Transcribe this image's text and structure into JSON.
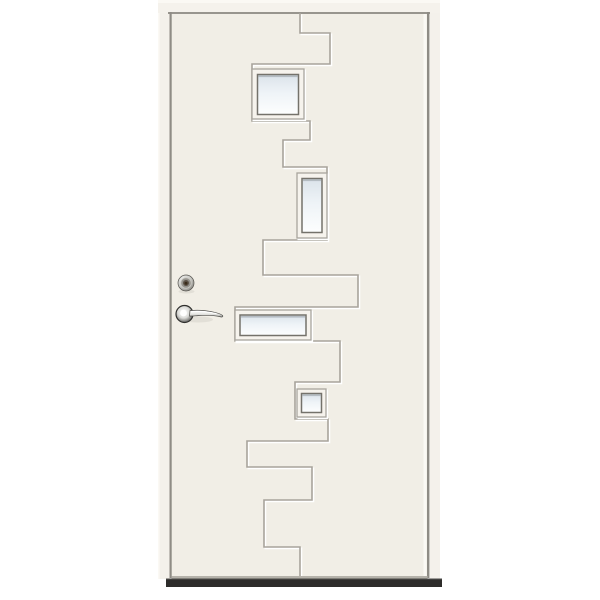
{
  "meta": {
    "domain": "natural-image",
    "subject": "white-front-door-with-zigzag-glazing",
    "canvas": [
      600,
      600
    ],
    "background": "#ffffff"
  },
  "palette": {
    "door_face": "#f1eee6",
    "frame_strip": "#f4f1eb",
    "head_strip": "#f5f2ec",
    "strip_highlight": "#fbf9f4",
    "edge_shadow": "#8f8c85",
    "top_edge_line": "#98958e",
    "groove_shadow": "#a8a49c",
    "groove_highlight": "#ffffff",
    "window_frame_face": "#f6f3ed",
    "window_frame_edge": "#a8a59d",
    "window_inner_line": "#74726b",
    "glass_top": "#dbe3ea",
    "glass_mid": "#eef3f7",
    "glass_bottom": "#fdfefe",
    "bottom_edge": "#b5b2aa",
    "threshold": "#2d2c2a",
    "threshold_top": "#4a4947",
    "chrome_light": "#f4f4f2",
    "chrome_mid": "#c6c6c2",
    "chrome_dark": "#77756f",
    "rose_ring": "#2f2f2d",
    "keyhole": "#3a2c1a",
    "soft_shadow": "rgba(120,115,105,0.12)"
  },
  "door": {
    "unit": [
      158,
      0,
      282,
      588
    ],
    "head_strip": [
      158,
      0,
      282,
      13
    ],
    "head_highlight": [
      158,
      0,
      282,
      3
    ],
    "top_edge_line": [
      168,
      12,
      262,
      2
    ],
    "left_strip": [
      158,
      13,
      12,
      566
    ],
    "left_strip_highlight": [
      158,
      13,
      1.5,
      566
    ],
    "left_edge_shadow": [
      169.5,
      12,
      2.2,
      566
    ],
    "right_strip": [
      429.5,
      13,
      10.5,
      566
    ],
    "right_edge_shadow": [
      427,
      12,
      2.4,
      566
    ],
    "right_inner_highlight": [
      423.5,
      14,
      3,
      562
    ],
    "face": [
      171.5,
      13.5,
      256,
      564.5
    ],
    "bottom_edge_line": [
      171.5,
      576,
      256,
      2.5
    ],
    "threshold": [
      166,
      578.5,
      276,
      8.5
    ],
    "groove_points": [
      [
        300,
        13
      ],
      [
        300,
        33
      ],
      [
        330,
        33
      ],
      [
        330,
        64
      ],
      [
        252,
        64
      ],
      [
        252,
        121
      ],
      [
        310,
        121
      ],
      [
        310,
        140
      ],
      [
        283,
        140
      ],
      [
        283,
        167
      ],
      [
        327,
        167
      ],
      [
        327,
        240
      ],
      [
        263,
        240
      ],
      [
        263,
        275
      ],
      [
        358,
        275
      ],
      [
        358,
        307
      ],
      [
        235,
        307
      ],
      [
        235,
        341
      ],
      [
        340,
        341
      ],
      [
        340,
        382
      ],
      [
        295,
        382
      ],
      [
        295,
        419
      ],
      [
        328,
        419
      ],
      [
        328,
        441
      ],
      [
        247,
        441
      ],
      [
        247,
        467
      ],
      [
        312,
        467
      ],
      [
        312,
        500
      ],
      [
        264,
        500
      ],
      [
        264,
        547
      ],
      [
        300,
        547
      ],
      [
        300,
        578
      ]
    ],
    "windows": [
      {
        "name": "window-1-square",
        "outer": [
          252,
          69,
          52,
          50
        ],
        "glass": [
          257.5,
          74.5,
          41,
          40
        ]
      },
      {
        "name": "window-2-tall",
        "outer": [
          297,
          173,
          30,
          65
        ],
        "glass": [
          302,
          178.5,
          20,
          54
        ]
      },
      {
        "name": "window-3-wide",
        "outer": [
          235,
          310,
          76,
          30
        ],
        "glass": [
          240,
          315,
          66,
          20.5
        ]
      },
      {
        "name": "window-4-small-square",
        "outer": [
          297,
          389,
          29,
          28
        ],
        "glass": [
          301.5,
          393.5,
          20,
          19
        ]
      }
    ],
    "hardware": {
      "cylinder": {
        "cx": 186,
        "cy": 283,
        "r": 8,
        "inner_r": 5.2,
        "core_r": 3,
        "key_r": 1.5
      },
      "rose": {
        "cx": 184.5,
        "cy": 314,
        "r": 8.5
      },
      "lever_path": "M 190 310.6 C 198 309.8 207 310.6 214 312.2 C 218 313.1 221.5 314.3 222.6 315.6 C 223.3 316.5 222.3 317.3 220.8 316.9 C 214 315.2 206 315 198 315.6 C 194.5 315.9 191 316.4 189.5 316 Z",
      "lever_highlight_path": "M 191 311.8 C 199 311 208 311.8 216 313.6",
      "cylinder_shadow": {
        "cx": 186.5,
        "cy": 291.5,
        "rx": 8,
        "ry": 2
      },
      "handle_shadow": {
        "cx": 198,
        "cy": 319.5,
        "rx": 15,
        "ry": 3
      }
    }
  }
}
